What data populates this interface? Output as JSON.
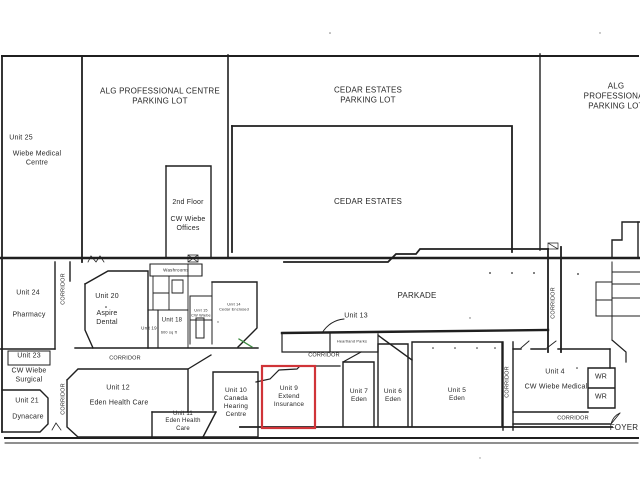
{
  "plan": {
    "highlight_color": "#d03438",
    "line_color": "#1f1f1f",
    "green_mark_color": "#3d8a41",
    "background": "#ffffff"
  },
  "parking": {
    "alg_left": "ALG PROFESSIONAL CENTRE\nPARKING LOT",
    "cedar": "CEDAR ESTATES\nPARKING LOT",
    "alg_right": "ALG PROFESSIONAL\nPARKING LOT"
  },
  "areas": {
    "parkade": "PARKADE",
    "cedar_estates": "CEDAR ESTATES",
    "second_floor": "2nd Floor\n\nCW Wiebe\nOffices",
    "washrooms": "Washrooms",
    "heartland": "Heartland Parks",
    "corridor": "CORRIDOR",
    "foyer": "FOYER"
  },
  "units": {
    "u25_no": "Unit 25",
    "u25_name": "Wiebe Medical\nCentre",
    "u24_no": "Unit 24",
    "u24_name": "Pharmacy",
    "u23_no": "Unit 23",
    "u23_name": "CW Wiebe\nSurgical",
    "u21_no": "Unit 21",
    "u21_name": "Dynacare",
    "u20": "Unit 20\n\nAspire\nDental",
    "u19": "Unit 19",
    "u18": "Unit 18",
    "u18_area": "600 sq ft",
    "u15": "Unit 15\nCW Wiebe",
    "u14": "Unit 14\nCedar Enclosed",
    "u13": "Unit 13",
    "u12_no": "Unit 12",
    "u12_name": "Eden Health Care",
    "u11": "Unit 11\nEden Health\nCare",
    "u10": "Unit 10\nCanada\nHearing\nCentre",
    "u9": "Unit 9\nExtend\nInsurance",
    "u7": "Unit 7\nEden",
    "u6": "Unit 6\nEden",
    "u5": "Unit 5\nEden",
    "u4_no": "Unit 4",
    "u4_name": "CW Wiebe Medical",
    "wr": "WR"
  }
}
